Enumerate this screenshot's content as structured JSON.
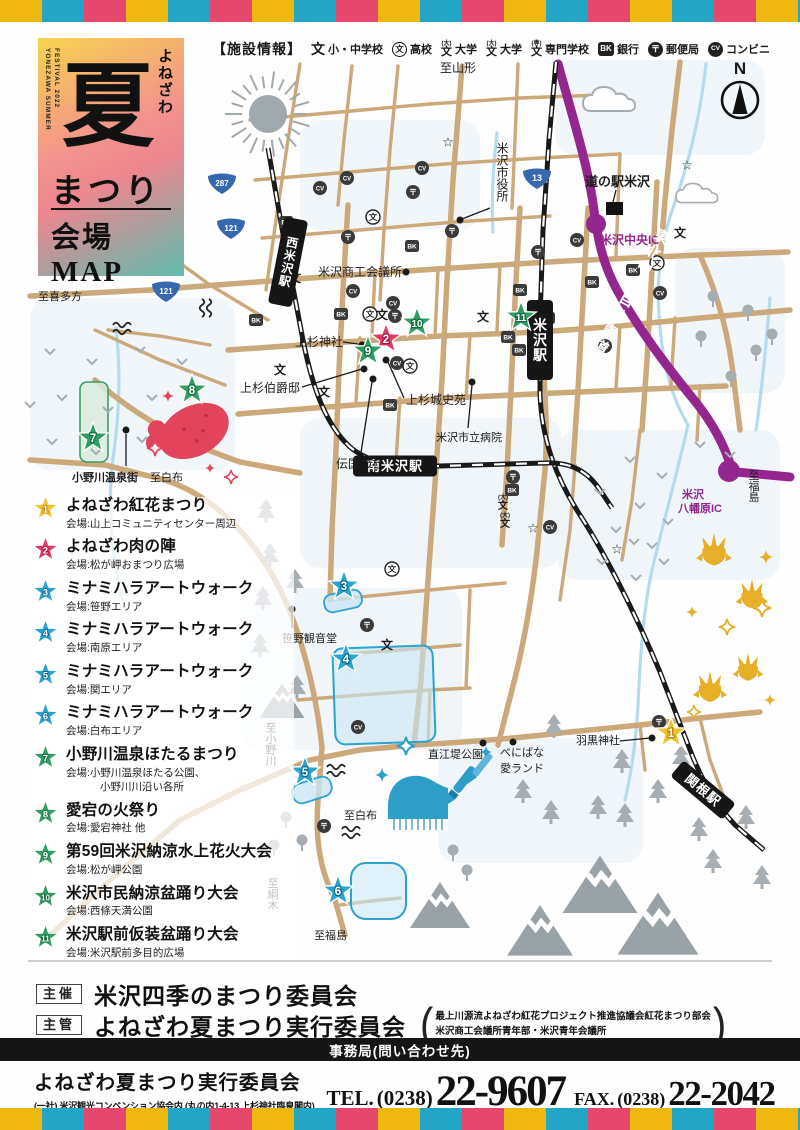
{
  "logo": {
    "en_vertical": "YONEZAWA SUMMER\nFESTIVAL 2022",
    "kana_vertical": "よねざわ",
    "big_char": "夏",
    "matsuri": "まつり",
    "map_label": "会場MAP"
  },
  "legend": {
    "title": "【施設情報】",
    "items": [
      {
        "label": "小・中学校"
      },
      {
        "label": "高校"
      },
      {
        "label": "大学"
      },
      {
        "label": "大学"
      },
      {
        "label": "専門学校"
      },
      {
        "label": "銀行"
      },
      {
        "label": "郵便局"
      },
      {
        "label": "コンビニ"
      }
    ],
    "glyphs": {
      "bun": "文",
      "dai": "(大)",
      "sen": "(専)",
      "bk": "BK",
      "post": "〒",
      "cv": "CV",
      "hoshi": "☆"
    }
  },
  "compass": {
    "label": "N"
  },
  "map": {
    "stations": [
      {
        "name": "西米沢駅",
        "x": 288,
        "y": 262,
        "rotate": 11,
        "vertical": true,
        "w": 24,
        "h": 88,
        "fs": 12
      },
      {
        "name": "米沢駅",
        "x": 540,
        "y": 340,
        "rotate": 0,
        "vertical": true,
        "w": 26,
        "h": 80,
        "fs": 14
      },
      {
        "name": "南米沢駅",
        "x": 395,
        "y": 466,
        "rotate": 0,
        "vertical": false,
        "w": 84,
        "h": 21,
        "fs": 13
      },
      {
        "name": "関根駅",
        "x": 703,
        "y": 790,
        "rotate": 40,
        "vertical": false,
        "w": 68,
        "h": 21,
        "fs": 13
      }
    ],
    "shields": [
      {
        "num": "287",
        "x": 222,
        "y": 183
      },
      {
        "num": "121",
        "x": 231,
        "y": 228
      },
      {
        "num": "121",
        "x": 166,
        "y": 291
      },
      {
        "num": "13",
        "x": 537,
        "y": 178
      }
    ],
    "labels": [
      {
        "text": "至山形",
        "x": 440,
        "y": 72,
        "fs": 12,
        "anchor": "start"
      },
      {
        "text": "道の駅米沢",
        "x": 585,
        "y": 186,
        "fs": 13,
        "bold": true,
        "anchor": "start"
      },
      {
        "text": "米沢中央IC",
        "x": 600,
        "y": 244,
        "fs": 12,
        "bold": true,
        "color": "#93278F",
        "anchor": "start"
      },
      {
        "text": "東北中央自動車道",
        "x": 630,
        "y": 292,
        "fs": 15,
        "bold": true,
        "color": "#FFFFFF",
        "vertical": true,
        "rotate": 29,
        "ls": 3
      },
      {
        "text": "米沢市役所",
        "x": 502,
        "y": 172,
        "fs": 12,
        "vertical": true
      },
      {
        "text": "米沢商工会議所",
        "x": 318,
        "y": 276,
        "fs": 12,
        "anchor": "start"
      },
      {
        "text": "上杉神社",
        "x": 295,
        "y": 346,
        "fs": 12,
        "anchor": "start"
      },
      {
        "text": "上杉伯爵邸",
        "x": 240,
        "y": 392,
        "fs": 12,
        "anchor": "start"
      },
      {
        "text": "伝国の杜",
        "x": 336,
        "y": 468,
        "fs": 12,
        "anchor": "start"
      },
      {
        "text": "上杉城史苑",
        "x": 406,
        "y": 404,
        "fs": 12,
        "anchor": "start"
      },
      {
        "text": "米沢市立病院",
        "x": 436,
        "y": 441,
        "fs": 11,
        "anchor": "start"
      },
      {
        "text": "至喜多方",
        "x": 38,
        "y": 300,
        "fs": 11,
        "anchor": "start"
      },
      {
        "text": "小野川温泉街",
        "x": 72,
        "y": 481,
        "fs": 11,
        "bold": true,
        "anchor": "start"
      },
      {
        "text": "至白布",
        "x": 150,
        "y": 481,
        "fs": 11,
        "anchor": "start"
      },
      {
        "text": "笹野観音堂",
        "x": 282,
        "y": 642,
        "fs": 11,
        "anchor": "start"
      },
      {
        "text": "至小野川",
        "x": 270,
        "y": 744,
        "fs": 11,
        "vertical": true
      },
      {
        "text": "至白布",
        "x": 344,
        "y": 819,
        "fs": 11,
        "anchor": "start"
      },
      {
        "text": "至綱木",
        "x": 272,
        "y": 894,
        "fs": 11,
        "vertical": true
      },
      {
        "text": "至福島",
        "x": 314,
        "y": 939,
        "fs": 11,
        "anchor": "start"
      },
      {
        "text": "直江堤公園",
        "x": 428,
        "y": 758,
        "fs": 11,
        "anchor": "start"
      },
      {
        "text": "べにばな",
        "x": 500,
        "y": 756,
        "fs": 11,
        "anchor": "start"
      },
      {
        "text": "愛ランド",
        "x": 500,
        "y": 772,
        "fs": 11,
        "anchor": "start"
      },
      {
        "text": "羽黒神社",
        "x": 576,
        "y": 744,
        "fs": 11,
        "anchor": "start"
      },
      {
        "text": "米沢",
        "x": 693,
        "y": 498,
        "fs": 11,
        "bold": true,
        "color": "#93278F"
      },
      {
        "text": "八幡原IC",
        "x": 700,
        "y": 512,
        "fs": 11,
        "bold": true,
        "color": "#93278F"
      },
      {
        "text": "至福島",
        "x": 753,
        "y": 486,
        "fs": 11,
        "vertical": true
      }
    ],
    "venues": [
      {
        "num": "1",
        "color": "yellow",
        "x": 671,
        "y": 733
      },
      {
        "num": "2",
        "color": "red",
        "x": 386,
        "y": 339
      },
      {
        "num": "3",
        "color": "cyan",
        "x": 344,
        "y": 586
      },
      {
        "num": "4",
        "color": "cyan",
        "x": 346,
        "y": 659
      },
      {
        "num": "5",
        "color": "cyan",
        "x": 305,
        "y": 772
      },
      {
        "num": "6",
        "color": "cyan",
        "x": 338,
        "y": 891
      },
      {
        "num": "7",
        "color": "green",
        "x": 93,
        "y": 438
      },
      {
        "num": "8",
        "color": "green",
        "x": 192,
        "y": 390
      },
      {
        "num": "9",
        "color": "green",
        "x": 368,
        "y": 351
      },
      {
        "num": "10",
        "color": "green",
        "x": 417,
        "y": 323
      },
      {
        "num": "11",
        "color": "green",
        "x": 521,
        "y": 317
      }
    ],
    "icons": [
      {
        "type": "bk",
        "x": 412,
        "y": 246
      },
      {
        "type": "bk",
        "x": 341,
        "y": 314
      },
      {
        "type": "bk",
        "x": 256,
        "y": 320
      },
      {
        "type": "bk",
        "x": 520,
        "y": 290
      },
      {
        "type": "bk",
        "x": 548,
        "y": 318
      },
      {
        "type": "bk",
        "x": 592,
        "y": 282
      },
      {
        "type": "bk",
        "x": 633,
        "y": 270
      },
      {
        "type": "bk",
        "x": 286,
        "y": 222
      },
      {
        "type": "bk",
        "x": 508,
        "y": 337
      },
      {
        "type": "bk",
        "x": 519,
        "y": 350
      },
      {
        "type": "bk",
        "x": 512,
        "y": 490
      },
      {
        "type": "bk",
        "x": 390,
        "y": 405
      },
      {
        "type": "post",
        "x": 348,
        "y": 237
      },
      {
        "type": "post",
        "x": 413,
        "y": 192
      },
      {
        "type": "post",
        "x": 452,
        "y": 231
      },
      {
        "type": "post",
        "x": 395,
        "y": 316
      },
      {
        "type": "post",
        "x": 367,
        "y": 625
      },
      {
        "type": "post",
        "x": 324,
        "y": 826
      },
      {
        "type": "post",
        "x": 659,
        "y": 722
      },
      {
        "type": "post",
        "x": 513,
        "y": 477
      },
      {
        "type": "post",
        "x": 538,
        "y": 252
      },
      {
        "type": "cv",
        "x": 353,
        "y": 291
      },
      {
        "type": "cv",
        "x": 393,
        "y": 303
      },
      {
        "type": "cv",
        "x": 347,
        "y": 178
      },
      {
        "type": "cv",
        "x": 422,
        "y": 168
      },
      {
        "type": "cv",
        "x": 397,
        "y": 363
      },
      {
        "type": "cv",
        "x": 550,
        "y": 527
      },
      {
        "type": "cv",
        "x": 358,
        "y": 727
      },
      {
        "type": "cv",
        "x": 605,
        "y": 346
      },
      {
        "type": "cv",
        "x": 577,
        "y": 240
      },
      {
        "type": "cv",
        "x": 320,
        "y": 188
      },
      {
        "type": "cv",
        "x": 660,
        "y": 293
      },
      {
        "type": "es",
        "x": 382,
        "y": 315
      },
      {
        "type": "es",
        "x": 324,
        "y": 392
      },
      {
        "type": "es",
        "x": 280,
        "y": 370
      },
      {
        "type": "es",
        "x": 483,
        "y": 317
      },
      {
        "type": "es",
        "x": 387,
        "y": 645
      },
      {
        "type": "es",
        "x": 295,
        "y": 278
      },
      {
        "type": "es",
        "x": 680,
        "y": 233
      },
      {
        "type": "hs",
        "x": 370,
        "y": 314
      },
      {
        "type": "hs",
        "x": 410,
        "y": 366
      },
      {
        "type": "hs",
        "x": 392,
        "y": 569
      },
      {
        "type": "hs",
        "x": 657,
        "y": 263
      },
      {
        "type": "hs",
        "x": 373,
        "y": 217
      },
      {
        "type": "star",
        "x": 448,
        "y": 142
      },
      {
        "type": "star",
        "x": 533,
        "y": 528
      },
      {
        "type": "star",
        "x": 617,
        "y": 549
      },
      {
        "type": "star",
        "x": 687,
        "y": 165
      },
      {
        "type": "univ",
        "x": 503,
        "y": 503
      },
      {
        "type": "univ",
        "x": 505,
        "y": 521
      }
    ]
  },
  "star_colors": {
    "yellow": "#F2C12E",
    "red": "#E23A62",
    "cyan": "#2AA4CF",
    "green": "#2F9E62"
  },
  "star_dark": {
    "yellow": "#B8860B",
    "red": "#9C1B3E",
    "cyan": "#10678C",
    "green": "#156B40"
  },
  "events": [
    {
      "num": "1",
      "color": "yellow",
      "title": "よねざわ紅花まつり",
      "venue": [
        "会場:山上コミュニティセンター周辺"
      ]
    },
    {
      "num": "2",
      "color": "red",
      "title": "よねざわ肉の陣",
      "venue": [
        "会場:松が岬おまつり広場"
      ]
    },
    {
      "num": "3",
      "color": "cyan",
      "title": "ミナミハラアートウォーク",
      "venue": [
        "会場:笹野エリア"
      ]
    },
    {
      "num": "4",
      "color": "cyan",
      "title": "ミナミハラアートウォーク",
      "venue": [
        "会場:南原エリア"
      ]
    },
    {
      "num": "5",
      "color": "cyan",
      "title": "ミナミハラアートウォーク",
      "venue": [
        "会場:関エリア"
      ]
    },
    {
      "num": "6",
      "color": "cyan",
      "title": "ミナミハラアートウォーク",
      "venue": [
        "会場:白布エリア"
      ]
    },
    {
      "num": "7",
      "color": "green",
      "title": "小野川温泉ほたるまつり",
      "venue": [
        "会場:小野川温泉ほたる公園、",
        "小野川川沿い各所"
      ]
    },
    {
      "num": "8",
      "color": "green",
      "title": "愛宕の火祭り",
      "venue": [
        "会場:愛宕神社 他"
      ]
    },
    {
      "num": "9",
      "color": "green",
      "title": "第59回米沢納涼水上花火大会",
      "venue": [
        "会場:松が岬公園"
      ]
    },
    {
      "num": "10",
      "color": "green",
      "title": "米沢市民納涼盆踊り大会",
      "venue": [
        "会場:西條天満公園"
      ]
    },
    {
      "num": "11",
      "color": "green",
      "title": "米沢駅前仮装盆踊り大会",
      "venue": [
        "会場:米沢駅前多目的広場"
      ]
    }
  ],
  "footer": {
    "host_label": "主催",
    "host_name": "米沢四季のまつり委員会",
    "manage_label": "主管",
    "manage_name": "よねざわ夏まつり実行委員会",
    "paren_open": "(",
    "paren_close": ")",
    "manage_note1": "最上川源流よねざわ紅花プロジェクト推進協議会紅花まつり部会",
    "manage_note2": "米沢商工会議所青年部・米沢青年会議所",
    "office_bar": "事務局(問い合わせ先)",
    "office_name": "よねざわ夏まつり実行委員会",
    "office_addr": "(一社) 米沢観光コンベンション協会内 (丸の内1-4-13 上杉神社臨泉閣内)",
    "tel_label": "TEL.",
    "tel_area": "(0238)",
    "tel_number": "22-9607",
    "fax_label": "FAX.",
    "fax_area": "(0238)",
    "fax_number": "22-2042"
  }
}
